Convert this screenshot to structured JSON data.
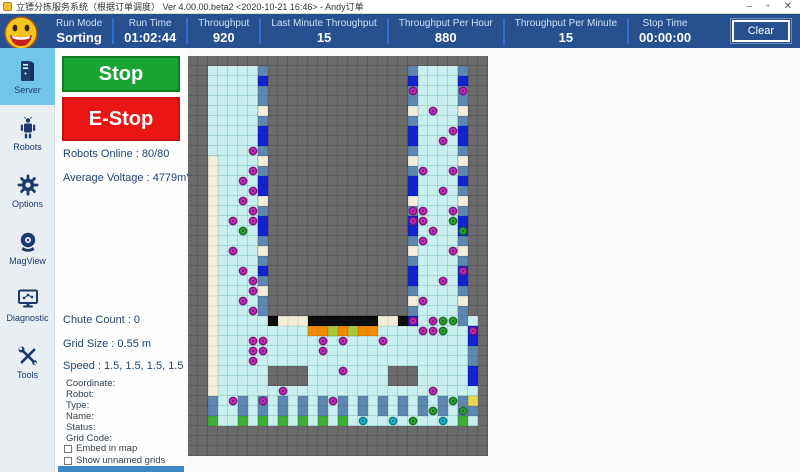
{
  "window": {
    "title": "立镖分拣服务系统（根据订单调度）  Ver 4.00.00.beta2 <2020-10-21 16:46> - Andy订单",
    "controls": {
      "minimize": "–",
      "maximize": "▫",
      "close": "✕"
    }
  },
  "header": {
    "accent_color": "#26508e",
    "divider_color": "#2e6fd4",
    "stats": [
      {
        "label": "Run Mode",
        "value": "Sorting"
      },
      {
        "label": "Run Time",
        "value": "01:02:44"
      },
      {
        "label": "Throughput",
        "value": "920"
      },
      {
        "label": "Last Minute Throughput",
        "value": "15"
      },
      {
        "label": "Throughput Per Hour",
        "value": "880"
      },
      {
        "label": "Throughput Per Minute",
        "value": "15"
      },
      {
        "label": "Stop Time",
        "value": "00:00:00"
      }
    ],
    "clear_label": "Clear"
  },
  "sidebar": {
    "active_color": "#70c5e8",
    "items": [
      {
        "label": "Server",
        "active": true
      },
      {
        "label": "Robots",
        "active": false
      },
      {
        "label": "Options",
        "active": false
      },
      {
        "label": "MagView",
        "active": false
      },
      {
        "label": "Diagnostic",
        "active": false
      },
      {
        "label": "Tools",
        "active": false
      }
    ]
  },
  "panel": {
    "stop_label": "Stop",
    "estop_label": "E-Stop",
    "robots_online": "Robots Online : 80/80",
    "average_voltage": "Average Voltage : 4779mV",
    "chute_count": "Chute Count : 0",
    "grid_size": "Grid Size : 0.55 m",
    "speed": "Speed : 1.5, 1.5, 1.5, 1.5",
    "fields": [
      "Coordinate:",
      "Robot:",
      "Type:",
      "Name:",
      "Status:",
      "Grid Code:"
    ],
    "checkboxes": [
      {
        "label": "Embed in map",
        "checked": false
      },
      {
        "label": "Show unnamed grids",
        "checked": false
      }
    ]
  },
  "map": {
    "cols": 30,
    "rows": 40,
    "cell": 10,
    "colors": {
      "bg": "#6a6a6a",
      "bg_line": "#525252",
      "cyan": "#c9efee",
      "cyan_line": "#7fc0c0",
      "steel": "#5d87b0",
      "blue": "#1322cf",
      "cream": "#f2eeda",
      "black": "#0d0d0d",
      "orange": "#ef8b00",
      "green": "#3fae36",
      "yellow": "#ead84e",
      "lime": "#a8c838"
    },
    "robot_colors": {
      "m": {
        "fill": "#c02cb4",
        "ring": "#7c1578"
      },
      "g": {
        "fill": "#2f9e35",
        "ring": "#1c6e22"
      },
      "t": {
        "fill": "#19b2c0",
        "ring": "#0e7e8a"
      }
    },
    "regions": [
      {
        "c": 2,
        "r": 1,
        "w": 6,
        "h": 25,
        "fill": "cyan"
      },
      {
        "c": 22,
        "r": 1,
        "w": 6,
        "h": 26,
        "fill": "cyan"
      },
      {
        "c": 2,
        "r": 26,
        "w": 27,
        "h": 11,
        "fill": "cyan"
      }
    ],
    "cutouts": [
      {
        "c": 8,
        "r": 31,
        "w": 4,
        "h": 2
      },
      {
        "c": 20,
        "r": 31,
        "w": 3,
        "h": 2
      }
    ],
    "cells": [
      {
        "c": 2,
        "r": 10,
        "v": 25,
        "color": "cream"
      },
      {
        "c": 7,
        "r": 1,
        "v": 25,
        "color": "steel"
      },
      {
        "c": 22,
        "r": 1,
        "v": 26,
        "color": "steel"
      },
      {
        "c": 27,
        "r": 1,
        "v": 26,
        "color": "steel"
      },
      {
        "c": 7,
        "r": 2,
        "color": "blue"
      },
      {
        "c": 7,
        "r": 7,
        "v": 2,
        "color": "blue"
      },
      {
        "c": 7,
        "r": 12,
        "v": 2,
        "color": "blue"
      },
      {
        "c": 7,
        "r": 16,
        "v": 2,
        "color": "blue"
      },
      {
        "c": 7,
        "r": 21,
        "color": "blue"
      },
      {
        "c": 7,
        "r": 5,
        "color": "cream"
      },
      {
        "c": 7,
        "r": 10,
        "color": "cream"
      },
      {
        "c": 7,
        "r": 14,
        "color": "cream"
      },
      {
        "c": 7,
        "r": 19,
        "color": "cream"
      },
      {
        "c": 7,
        "r": 23,
        "color": "cream"
      },
      {
        "c": 22,
        "r": 2,
        "color": "blue"
      },
      {
        "c": 22,
        "r": 7,
        "v": 2,
        "color": "blue"
      },
      {
        "c": 22,
        "r": 12,
        "v": 2,
        "color": "blue"
      },
      {
        "c": 22,
        "r": 16,
        "v": 2,
        "color": "blue"
      },
      {
        "c": 22,
        "r": 21,
        "v": 2,
        "color": "blue"
      },
      {
        "c": 22,
        "r": 26,
        "color": "blue"
      },
      {
        "c": 22,
        "r": 5,
        "color": "cream"
      },
      {
        "c": 22,
        "r": 10,
        "color": "cream"
      },
      {
        "c": 22,
        "r": 14,
        "color": "cream"
      },
      {
        "c": 22,
        "r": 19,
        "color": "cream"
      },
      {
        "c": 22,
        "r": 24,
        "color": "cream"
      },
      {
        "c": 27,
        "r": 2,
        "color": "blue"
      },
      {
        "c": 27,
        "r": 7,
        "v": 2,
        "color": "blue"
      },
      {
        "c": 27,
        "r": 12,
        "color": "blue"
      },
      {
        "c": 27,
        "r": 16,
        "v": 2,
        "color": "blue"
      },
      {
        "c": 27,
        "r": 21,
        "v": 2,
        "color": "blue"
      },
      {
        "c": 27,
        "r": 5,
        "color": "cream"
      },
      {
        "c": 27,
        "r": 10,
        "color": "cream"
      },
      {
        "c": 27,
        "r": 14,
        "color": "cream"
      },
      {
        "c": 27,
        "r": 19,
        "color": "cream"
      },
      {
        "c": 27,
        "r": 24,
        "color": "cream"
      },
      {
        "c": 28,
        "r": 27,
        "v": 2,
        "color": "blue"
      },
      {
        "c": 28,
        "r": 29,
        "v": 2,
        "color": "steel"
      },
      {
        "c": 28,
        "r": 31,
        "v": 2,
        "color": "blue"
      },
      {
        "c": 28,
        "r": 34,
        "color": "yellow"
      },
      {
        "c": 28,
        "r": 35,
        "color": "steel"
      },
      {
        "c": 8,
        "r": 26,
        "color": "black"
      },
      {
        "c": 9,
        "r": 26,
        "h": 3,
        "color": "cream"
      },
      {
        "c": 12,
        "r": 26,
        "h": 7,
        "color": "black"
      },
      {
        "c": 19,
        "r": 26,
        "h": 2,
        "color": "cream"
      },
      {
        "c": 21,
        "r": 26,
        "color": "black"
      },
      {
        "c": 12,
        "r": 27,
        "h": 7,
        "color": "orange"
      },
      {
        "c": 14,
        "r": 27,
        "color": "lime"
      },
      {
        "c": 16,
        "r": 27,
        "color": "lime"
      },
      {
        "c": 2,
        "r": 34,
        "v": 2,
        "color": "steel"
      },
      {
        "c": 5,
        "r": 34,
        "v": 2,
        "color": "steel"
      },
      {
        "c": 7,
        "r": 34,
        "v": 2,
        "color": "steel"
      },
      {
        "c": 9,
        "r": 34,
        "v": 2,
        "color": "steel"
      },
      {
        "c": 11,
        "r": 34,
        "v": 2,
        "color": "steel"
      },
      {
        "c": 13,
        "r": 34,
        "v": 2,
        "color": "steel"
      },
      {
        "c": 15,
        "r": 34,
        "v": 2,
        "color": "steel"
      },
      {
        "c": 17,
        "r": 34,
        "v": 2,
        "color": "steel"
      },
      {
        "c": 19,
        "r": 34,
        "v": 2,
        "color": "steel"
      },
      {
        "c": 21,
        "r": 34,
        "v": 2,
        "color": "steel"
      },
      {
        "c": 23,
        "r": 34,
        "v": 2,
        "color": "steel"
      },
      {
        "c": 25,
        "r": 34,
        "v": 2,
        "color": "steel"
      },
      {
        "c": 27,
        "r": 34,
        "v": 2,
        "color": "steel"
      },
      {
        "c": 2,
        "r": 36,
        "color": "green"
      },
      {
        "c": 5,
        "r": 36,
        "color": "green"
      },
      {
        "c": 7,
        "r": 36,
        "color": "green"
      },
      {
        "c": 9,
        "r": 36,
        "color": "green"
      },
      {
        "c": 11,
        "r": 36,
        "color": "green"
      },
      {
        "c": 13,
        "r": 36,
        "color": "green"
      },
      {
        "c": 15,
        "r": 36,
        "color": "green"
      },
      {
        "c": 27,
        "r": 36,
        "color": "green"
      }
    ],
    "robots": [
      {
        "c": 6,
        "r": 9,
        "t": "m"
      },
      {
        "c": 6,
        "r": 11,
        "t": "m"
      },
      {
        "c": 5,
        "r": 12,
        "t": "m"
      },
      {
        "c": 6,
        "r": 13,
        "t": "m"
      },
      {
        "c": 5,
        "r": 14,
        "t": "m"
      },
      {
        "c": 6,
        "r": 15,
        "t": "m"
      },
      {
        "c": 4,
        "r": 16,
        "t": "m"
      },
      {
        "c": 6,
        "r": 16,
        "t": "m"
      },
      {
        "c": 4,
        "r": 19,
        "t": "m"
      },
      {
        "c": 5,
        "r": 21,
        "t": "m"
      },
      {
        "c": 6,
        "r": 22,
        "t": "m"
      },
      {
        "c": 6,
        "r": 23,
        "t": "m"
      },
      {
        "c": 5,
        "r": 24,
        "t": "m"
      },
      {
        "c": 6,
        "r": 25,
        "t": "m"
      },
      {
        "c": 6,
        "r": 28,
        "t": "m"
      },
      {
        "c": 7,
        "r": 28,
        "t": "m"
      },
      {
        "c": 6,
        "r": 29,
        "t": "m"
      },
      {
        "c": 7,
        "r": 29,
        "t": "m"
      },
      {
        "c": 6,
        "r": 30,
        "t": "m"
      },
      {
        "c": 4,
        "r": 34,
        "t": "m"
      },
      {
        "c": 7,
        "r": 34,
        "t": "m"
      },
      {
        "c": 9,
        "r": 33,
        "t": "m"
      },
      {
        "c": 13,
        "r": 28,
        "t": "m"
      },
      {
        "c": 15,
        "r": 28,
        "t": "m"
      },
      {
        "c": 13,
        "r": 29,
        "t": "m"
      },
      {
        "c": 19,
        "r": 28,
        "t": "m"
      },
      {
        "c": 15,
        "r": 31,
        "t": "m"
      },
      {
        "c": 14,
        "r": 34,
        "t": "m"
      },
      {
        "c": 23,
        "r": 27,
        "t": "m"
      },
      {
        "c": 24,
        "r": 27,
        "t": "m"
      },
      {
        "c": 28,
        "r": 27,
        "t": "m"
      },
      {
        "c": 24,
        "r": 33,
        "t": "m"
      },
      {
        "c": 22,
        "r": 3,
        "t": "m"
      },
      {
        "c": 27,
        "r": 3,
        "t": "m"
      },
      {
        "c": 24,
        "r": 5,
        "t": "m"
      },
      {
        "c": 26,
        "r": 7,
        "t": "m"
      },
      {
        "c": 25,
        "r": 8,
        "t": "m"
      },
      {
        "c": 23,
        "r": 11,
        "t": "m"
      },
      {
        "c": 26,
        "r": 11,
        "t": "m"
      },
      {
        "c": 25,
        "r": 13,
        "t": "m"
      },
      {
        "c": 22,
        "r": 15,
        "t": "m"
      },
      {
        "c": 23,
        "r": 15,
        "t": "m"
      },
      {
        "c": 22,
        "r": 16,
        "t": "m"
      },
      {
        "c": 23,
        "r": 16,
        "t": "m"
      },
      {
        "c": 26,
        "r": 15,
        "t": "m"
      },
      {
        "c": 24,
        "r": 17,
        "t": "m"
      },
      {
        "c": 23,
        "r": 18,
        "t": "m"
      },
      {
        "c": 26,
        "r": 19,
        "t": "m"
      },
      {
        "c": 27,
        "r": 21,
        "t": "m"
      },
      {
        "c": 25,
        "r": 22,
        "t": "m"
      },
      {
        "c": 23,
        "r": 24,
        "t": "m"
      },
      {
        "c": 24,
        "r": 26,
        "t": "m"
      },
      {
        "c": 22,
        "r": 26,
        "t": "m"
      },
      {
        "c": 5,
        "r": 17,
        "t": "g"
      },
      {
        "c": 25,
        "r": 26,
        "t": "g"
      },
      {
        "c": 26,
        "r": 26,
        "t": "g"
      },
      {
        "c": 25,
        "r": 27,
        "t": "g"
      },
      {
        "c": 26,
        "r": 16,
        "t": "g"
      },
      {
        "c": 27,
        "r": 17,
        "t": "g"
      },
      {
        "c": 26,
        "r": 34,
        "t": "g"
      },
      {
        "c": 24,
        "r": 35,
        "t": "g"
      },
      {
        "c": 27,
        "r": 35,
        "t": "g"
      },
      {
        "c": 22,
        "r": 36,
        "t": "g"
      },
      {
        "c": 17,
        "r": 36,
        "t": "t"
      },
      {
        "c": 20,
        "r": 36,
        "t": "t"
      },
      {
        "c": 25,
        "r": 36,
        "t": "t"
      }
    ]
  }
}
